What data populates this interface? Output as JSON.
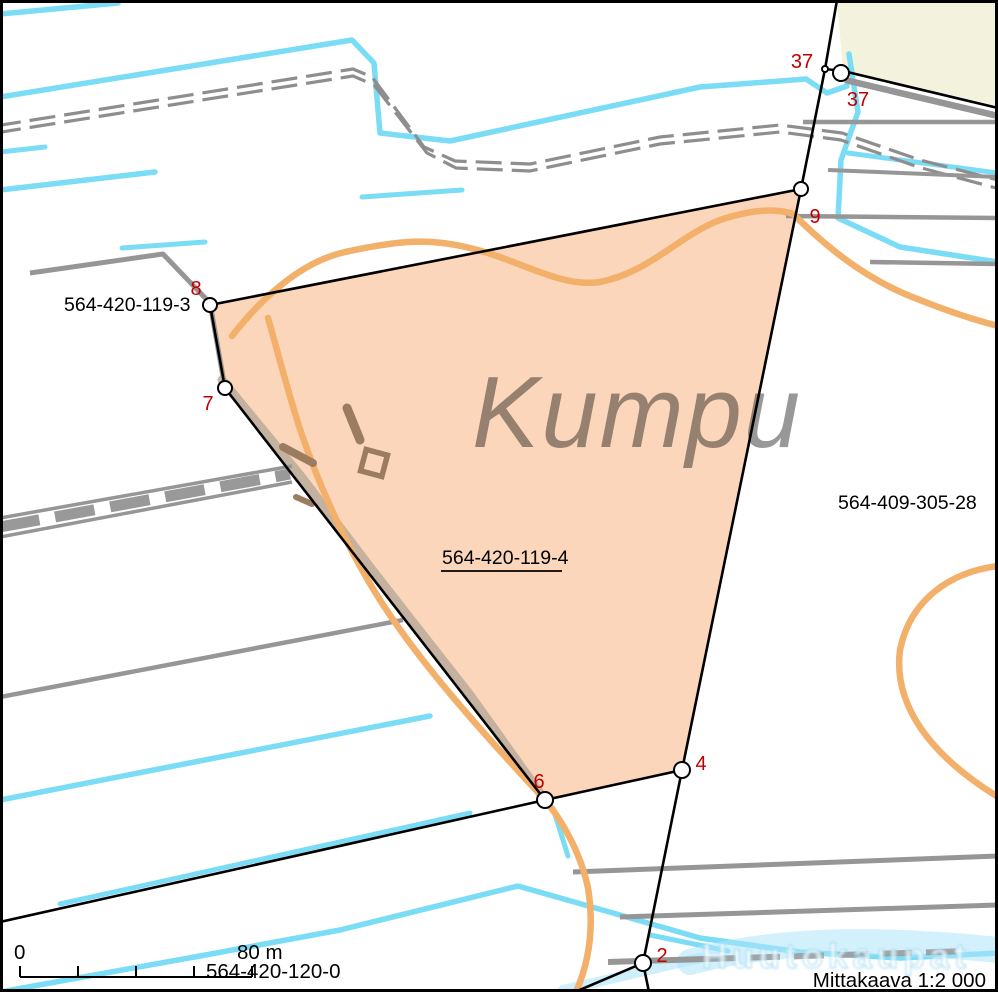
{
  "map": {
    "place_name": "Kumpu",
    "target_parcel": {
      "id": "564-420-119-4"
    },
    "neighbor_parcels": {
      "west": {
        "id": "564-420-119-3"
      },
      "east": {
        "id": "564-409-305-28"
      },
      "south": {
        "id": "564-420-120-0"
      }
    },
    "boundary_markers": {
      "p8": "8",
      "p7": "7",
      "p6": "6",
      "p4": "4",
      "p9": "9",
      "p37a": "37",
      "p37b": "37",
      "p2": "2"
    },
    "scale_bar": {
      "zero": "0",
      "length": "80 m"
    },
    "scale_caption": "Mittakaava 1:2 000",
    "watermark": "Huutokaupat",
    "colors": {
      "target_parcel_fill": "#FBD6BA",
      "neighbor_parcel_fill": "#F3F3DD",
      "water": "#7BDCF5",
      "contour": "#F2B06A",
      "road": "#969696",
      "building": "#9C7C61",
      "boundary": "#000000",
      "marker_label": "#C00000",
      "place_name_text": "#8F8F8F"
    }
  }
}
